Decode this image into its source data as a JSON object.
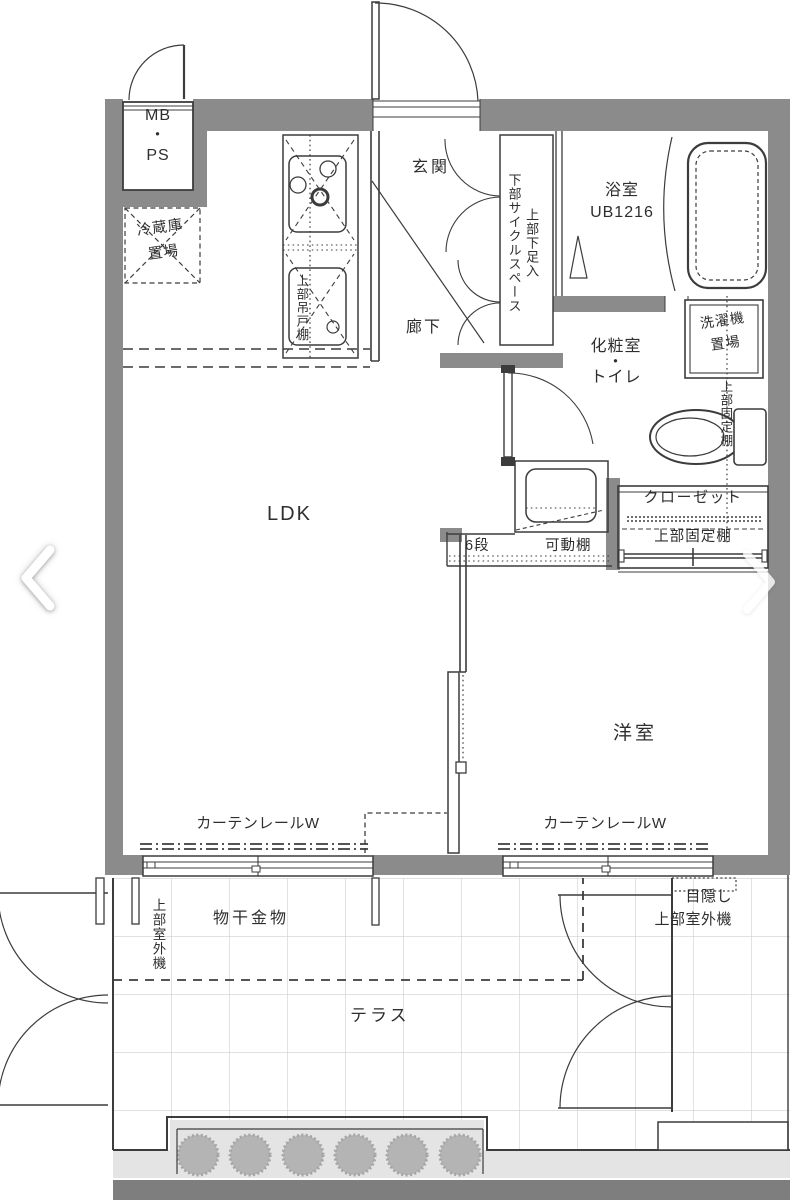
{
  "labels": {
    "mb_ps": "MB\n・\nPS",
    "fridge": "冷蔵庫\n置場",
    "kitchen_cabinet": "上部吊戸棚",
    "entrance": "玄関",
    "shoe_storage": "上部下足入\n下部サイクルスペース",
    "corridor": "廊下",
    "bathroom": "浴室\nUB1216",
    "powder_toilet": "化粧室\n・\nトイレ",
    "laundry": "洗濯機\n置場",
    "toilet_shelf": "上部固定棚",
    "closet": "クローゼット",
    "closet_shelf": "上部固定棚",
    "shelf_tiers": "6段",
    "movable_shelf": "可動棚",
    "ldk": "LDK",
    "western_room": "洋室",
    "curtain_rail_left": "カーテンレールW",
    "curtain_rail_right": "カーテンレールW",
    "laundry_hardware": "物干金物",
    "outdoor_unit_left": "上部室外機",
    "outdoor_unit_right": "目隠し\n上部室外機",
    "terrace": "テラス"
  },
  "icons": {
    "prev": "chevron-left-icon",
    "next": "chevron-right-icon"
  },
  "colors": {
    "wall": "#8b8b8b",
    "line": "#3c3c3c",
    "grid": "#cfcfcf",
    "planter": "#e4e4e4",
    "bush": "#b4b4b4",
    "bar": "#7e7e7e",
    "ink": "#2e2e2e",
    "chevron": "#ffffff"
  }
}
